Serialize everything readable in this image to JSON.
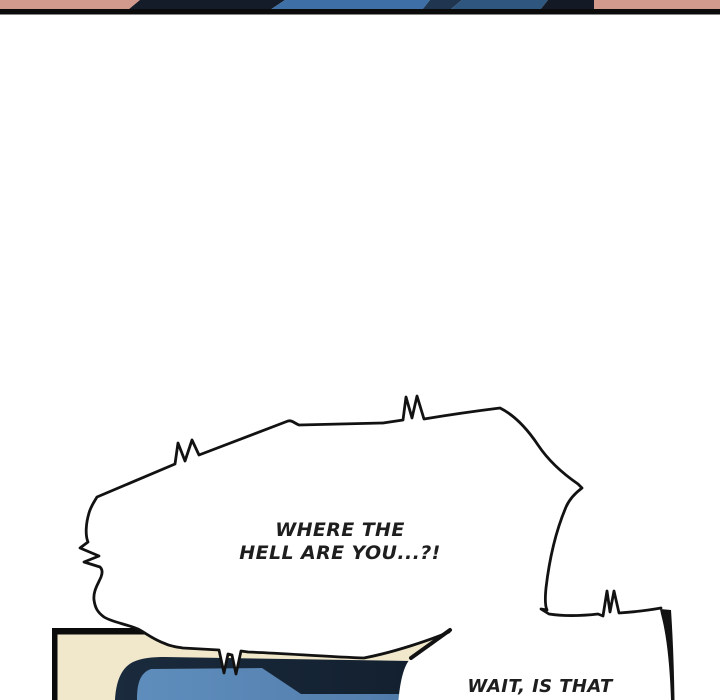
{
  "bubbles": {
    "shout": {
      "line1": "WHERE THE",
      "line2": "HELL ARE YOU...?!"
    },
    "reply": {
      "line1": "WAIT, IS THAT"
    }
  },
  "colors": {
    "page_background": "#ffffff",
    "ink_outline": "#121212",
    "panel_divider": "#0b0b0b",
    "strip_salmon": "#d29a8d",
    "strip_dark": "#141c29",
    "strip_blue": "#3e6fa7",
    "strip_blue_dark": "#2e567f",
    "panel_cream": "#f1e8cc",
    "panel_navy": "#1a2b3d",
    "panel_blue": "#5e8dbc"
  }
}
